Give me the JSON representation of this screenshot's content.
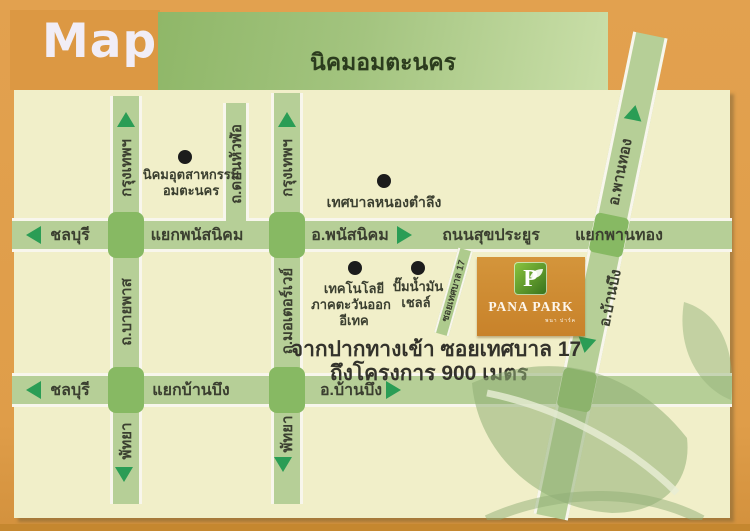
{
  "header": {
    "map_label": "Map",
    "banner": "นิคมอมตะนคร"
  },
  "roads": {
    "sukprayoon": {
      "west": "ชลบุรี",
      "junction_west": "แยกพนัสนิคม",
      "dir_east": "อ.พนัสนิคม",
      "name": "ถนนสุขประยูร",
      "junction_east": "แยกพานทอง"
    },
    "banbueng_road": {
      "west": "ชลบุรี",
      "junction": "แยกบ้านบึง",
      "dir_east": "อ.บ้านบึง"
    },
    "bypass": {
      "north": "กรุงเทพฯ",
      "middle": "ถ.บายพาส",
      "south": "พัทยา"
    },
    "motorway": {
      "north": "กรุงเทพฯ",
      "middle": "ถ.มอเตอร์เวย์",
      "south": "พัทยา"
    },
    "donhualo": {
      "name": "ถ.ดอนหัวฬ่อ"
    },
    "diagonal": {
      "north": "อ.พานทอง",
      "south": "อ.บ้านบึง"
    },
    "soi": {
      "name": "ซอยเทศบาล 17"
    }
  },
  "pois": [
    {
      "lines": [
        "นิคมอุตสาหกรรม",
        "อมตะนคร"
      ]
    },
    {
      "lines": [
        "เทศบาลหนองตำลึง"
      ]
    },
    {
      "lines": [
        "เทคโนโลยี",
        "ภาคตะวันออก",
        "อีเทค"
      ]
    },
    {
      "lines": [
        "ปั๊มน้ำมัน",
        "เชลล์"
      ]
    }
  ],
  "project": {
    "initial": "P",
    "name": "PANA PARK",
    "subtitle": "พนา ปาร์ค"
  },
  "caption": {
    "line1": "จากปากทางเข้า ซอยเทศบาล 17",
    "line2": "ถึงโครงการ 900 เมตร"
  },
  "colors": {
    "frame_orange": "#df9d49",
    "map_bg": "#f1efc9",
    "road_green": "#b6cf97",
    "crossing_green": "#87b963",
    "arrow_green": "#2a9d55",
    "banner_green": "#9fc077",
    "label_dark": "#3b3f30",
    "project_orange": "#cd8930",
    "logo_green": "#4f9427"
  }
}
